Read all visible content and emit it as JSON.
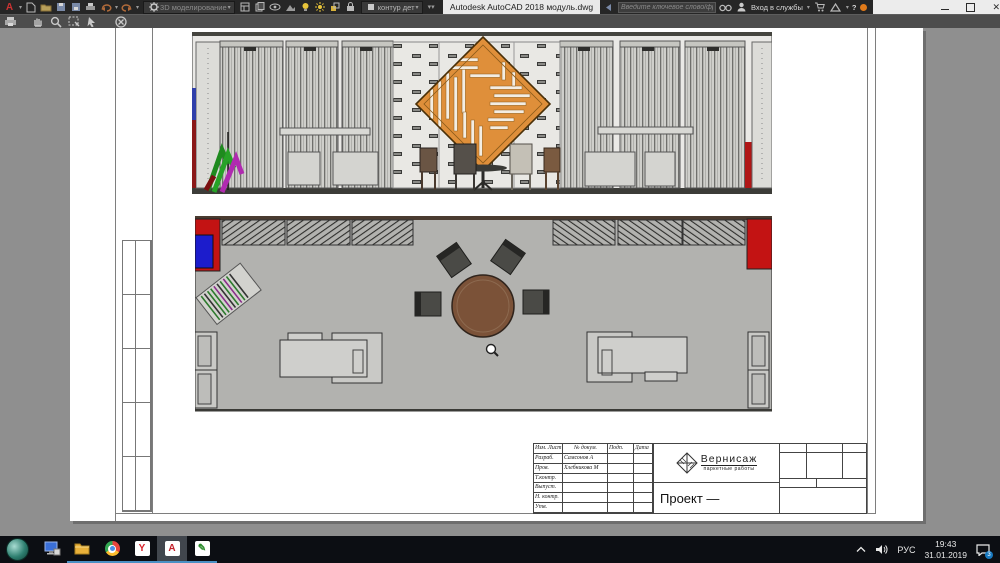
{
  "titlebar": {
    "app_title": "Autodesk AutoCAD 2018   модуль.dwg",
    "workspace": "3D моделирование",
    "layer": "контур дет",
    "search_placeholder": "Введите ключевое слово/фразу",
    "signin_label": "Вход в службы",
    "help_label": "?"
  },
  "sheet": {
    "titleblock": {
      "header_cols": [
        "Изм. Лист",
        "№ докум.",
        "Подп.",
        "Дата"
      ],
      "rows": [
        {
          "label": "Разраб.",
          "name": "Самсонов А"
        },
        {
          "label": "Пров.",
          "name": "Хлебникова М"
        },
        {
          "label": "Т.контр.",
          "name": ""
        },
        {
          "label": "Выпуст.",
          "name": ""
        },
        {
          "label": "Н. контр.",
          "name": ""
        },
        {
          "label": "Утв.",
          "name": ""
        }
      ],
      "company": "Вернисаж",
      "company_sub": "паркетные работы",
      "project_label": "Проект —"
    }
  },
  "taskbar": {
    "tray": {
      "lang": "РУС",
      "time": "19:43",
      "date": "31.01.2019",
      "notif_count": "3"
    }
  },
  "colors": {
    "accent_orange": "#df8f3a",
    "stand_red": "#c31313",
    "stand_blue": "#1c1ccc",
    "table_brown": "#7b5238",
    "taskbar_underline": "#4a90c4"
  }
}
